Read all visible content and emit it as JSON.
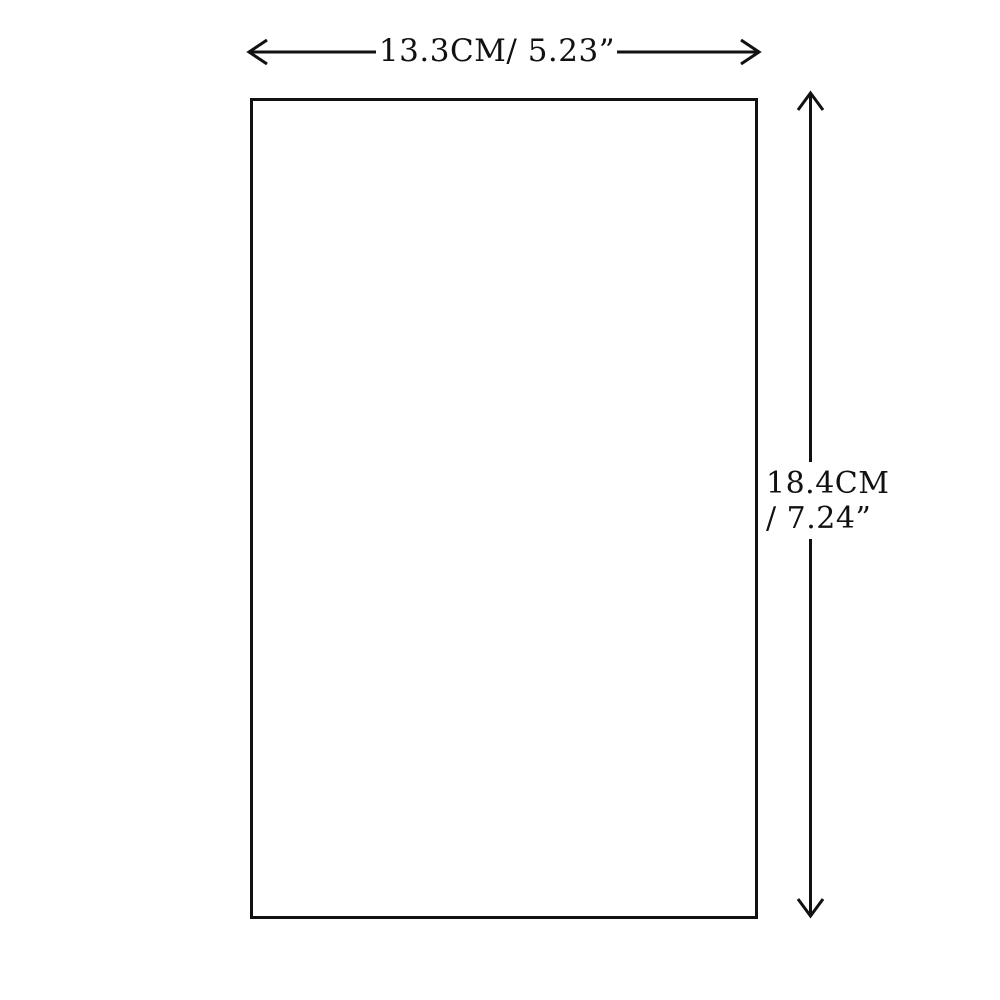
{
  "diagram": {
    "type": "product-dimension-diagram",
    "background_color": "#ffffff",
    "line_color": "#111111",
    "shape": "rectangle",
    "width_dimension": {
      "label": "13.3CM/ 5.23”"
    },
    "height_dimension": {
      "label_line1": "18.4CM",
      "label_line2": "/ 7.24”"
    }
  }
}
